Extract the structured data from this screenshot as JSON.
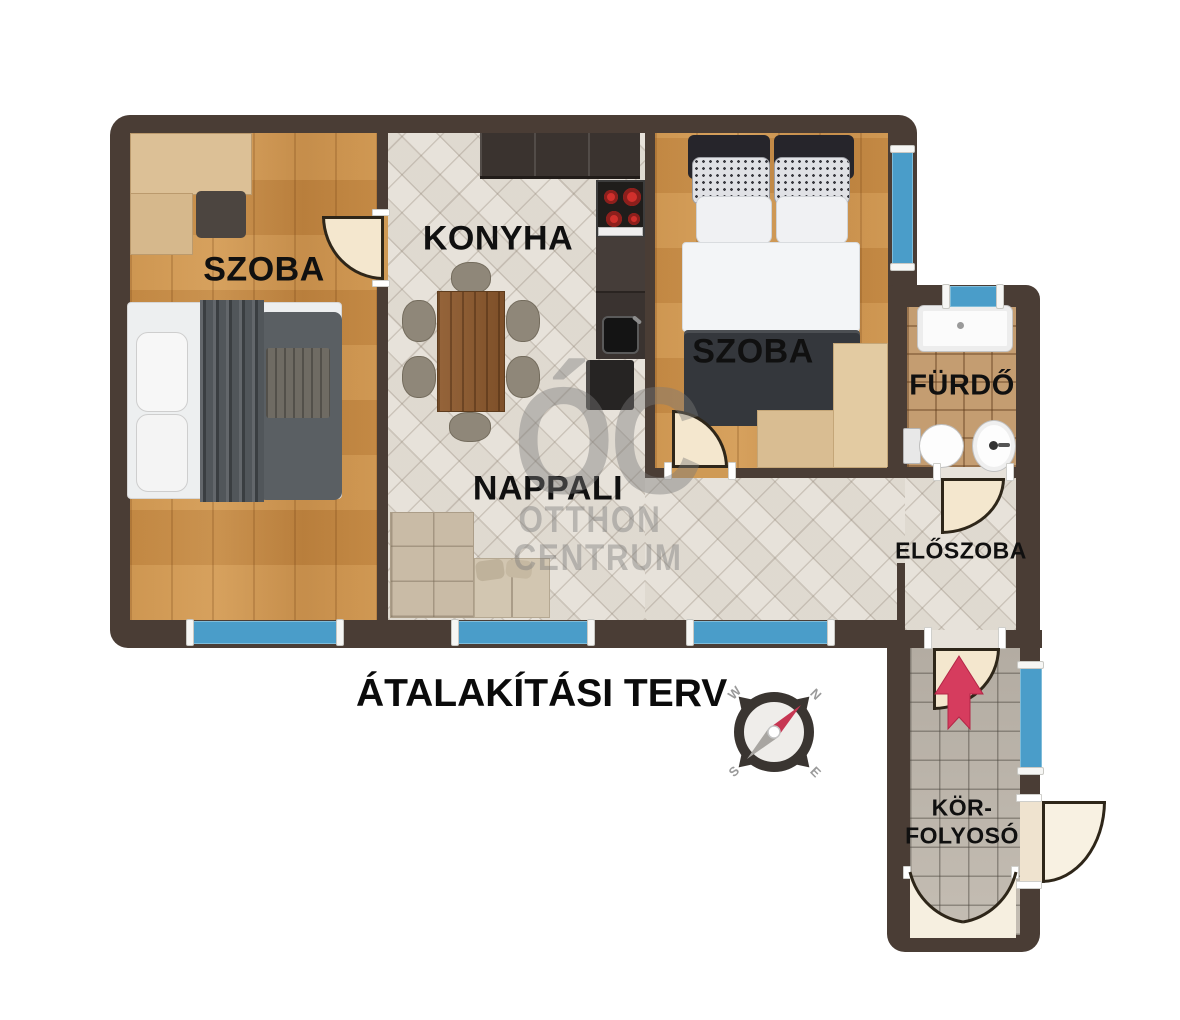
{
  "plan": {
    "title": "ÁTALAKÍTÁSI TERV",
    "watermark": {
      "monogram": "ÓC",
      "line1": "OTTHON",
      "line2": "CENTRUM"
    },
    "rooms": [
      {
        "id": "szoba-left",
        "label": "SZOBA"
      },
      {
        "id": "konyha",
        "label": "KONYHA"
      },
      {
        "id": "szoba-right",
        "label": "SZOBA"
      },
      {
        "id": "furdo",
        "label": "FÜRDŐ"
      },
      {
        "id": "nappali",
        "label": "NAPPALI"
      },
      {
        "id": "eloszoba",
        "label": "ELŐSZOBA"
      },
      {
        "id": "korfolyoso",
        "label_line1": "KÖR-",
        "label_line2": "FOLYOSÓ"
      }
    ],
    "compass": {
      "west": "W",
      "north": "N",
      "south": "S",
      "east": "E"
    },
    "colors": {
      "wall": "#4a3d35",
      "window": "#4a9dc9",
      "wood_floor": "#c98e47",
      "tile_floor": "#e7e2da",
      "bath_tile": "#c49d71",
      "corridor_tile": "#b8b1a7",
      "entry_arrow": "#d63c5e",
      "door": "#f4e7ce"
    }
  }
}
